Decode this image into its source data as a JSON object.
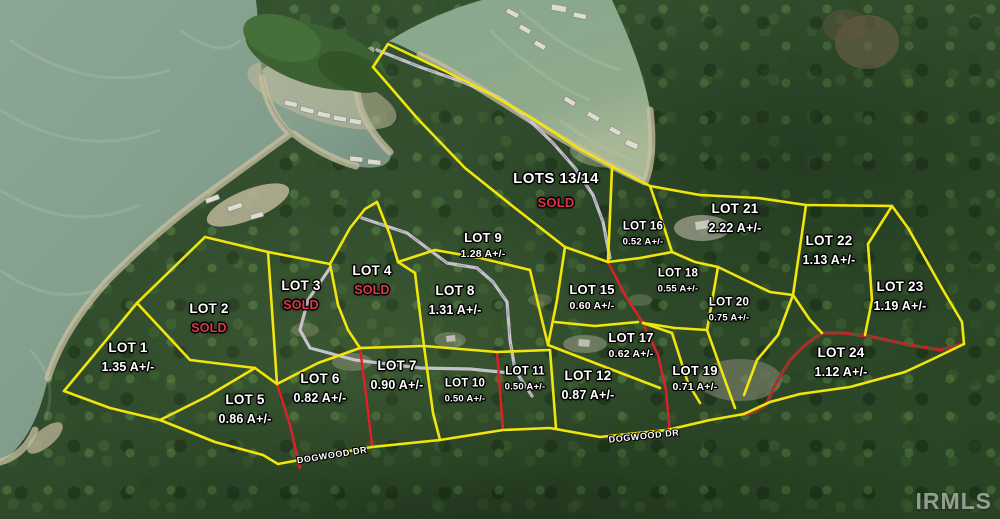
{
  "map": {
    "watermark": "IRMLS",
    "colors": {
      "boundary": "#f2e50c",
      "driveway": "#e02028",
      "sold": "#e0364a",
      "label": "#ffffff",
      "road": "#cdc7d2",
      "water": "#87a18f",
      "forest": "#2d4b28"
    },
    "road_labels": [
      {
        "text": "DOGWOOD DR",
        "x": 332,
        "y": 455,
        "rot": -9
      },
      {
        "text": "DOGWOOD DR",
        "x": 644,
        "y": 436,
        "rot": -6
      }
    ],
    "lots": [
      {
        "name": "LOT 1",
        "detail": "1.35 A+/-",
        "sold": false,
        "x": 128,
        "y": 357,
        "size": "md"
      },
      {
        "name": "LOT 2",
        "detail": "SOLD",
        "sold": true,
        "x": 209,
        "y": 318,
        "size": "md"
      },
      {
        "name": "LOT 3",
        "detail": "SOLD",
        "sold": true,
        "x": 301,
        "y": 295,
        "size": "md"
      },
      {
        "name": "LOT 4",
        "detail": "SOLD",
        "sold": true,
        "x": 372,
        "y": 280,
        "size": "md"
      },
      {
        "name": "LOT 5",
        "detail": "0.86 A+/-",
        "sold": false,
        "x": 245,
        "y": 409,
        "size": "md"
      },
      {
        "name": "LOT 6",
        "detail": "0.82 A+/-",
        "sold": false,
        "x": 320,
        "y": 388,
        "size": "md"
      },
      {
        "name": "LOT 7",
        "detail": "0.90 A+/-",
        "sold": false,
        "x": 397,
        "y": 375,
        "size": "md"
      },
      {
        "name": "LOT 8",
        "detail": "1.31 A+/-",
        "sold": false,
        "x": 455,
        "y": 300,
        "size": "md"
      },
      {
        "name": "LOT 9",
        "detail": "1.28 A+/-",
        "sold": false,
        "x": 483,
        "y": 245,
        "size": "sm"
      },
      {
        "name": "LOT 10",
        "detail": "0.50 A+/-",
        "sold": false,
        "x": 465,
        "y": 391,
        "size": "xs"
      },
      {
        "name": "LOT 11",
        "detail": "0.50 A+/-",
        "sold": false,
        "x": 525,
        "y": 379,
        "size": "xs"
      },
      {
        "name": "LOT 12",
        "detail": "0.87 A+/-",
        "sold": false,
        "x": 588,
        "y": 385,
        "size": "md"
      },
      {
        "name": "LOTS 13/14",
        "detail": "SOLD",
        "sold": true,
        "x": 556,
        "y": 190,
        "size": "lg"
      },
      {
        "name": "LOT 15",
        "detail": "0.60 A+/-",
        "sold": false,
        "x": 592,
        "y": 297,
        "size": "sm"
      },
      {
        "name": "LOT 16",
        "detail": "0.52 A+/-",
        "sold": false,
        "x": 643,
        "y": 234,
        "size": "xs"
      },
      {
        "name": "LOT 17",
        "detail": "0.62 A+/-",
        "sold": false,
        "x": 631,
        "y": 345,
        "size": "sm"
      },
      {
        "name": "LOT 18",
        "detail": "0.55 A+/-",
        "sold": false,
        "x": 678,
        "y": 281,
        "size": "xs"
      },
      {
        "name": "LOT 19",
        "detail": "0.71 A+/-",
        "sold": false,
        "x": 695,
        "y": 378,
        "size": "sm"
      },
      {
        "name": "LOT 20",
        "detail": "0.75 A+/-",
        "sold": false,
        "x": 729,
        "y": 310,
        "size": "xs"
      },
      {
        "name": "LOT 21",
        "detail": "2.22 A+/-",
        "sold": false,
        "x": 735,
        "y": 218,
        "size": "md"
      },
      {
        "name": "LOT 22",
        "detail": "1.13 A+/-",
        "sold": false,
        "x": 829,
        "y": 250,
        "size": "md"
      },
      {
        "name": "LOT 23",
        "detail": "1.19 A+/-",
        "sold": false,
        "x": 900,
        "y": 296,
        "size": "md"
      },
      {
        "name": "LOT 24",
        "detail": "1.12 A+/-",
        "sold": false,
        "x": 841,
        "y": 362,
        "size": "md"
      }
    ]
  }
}
